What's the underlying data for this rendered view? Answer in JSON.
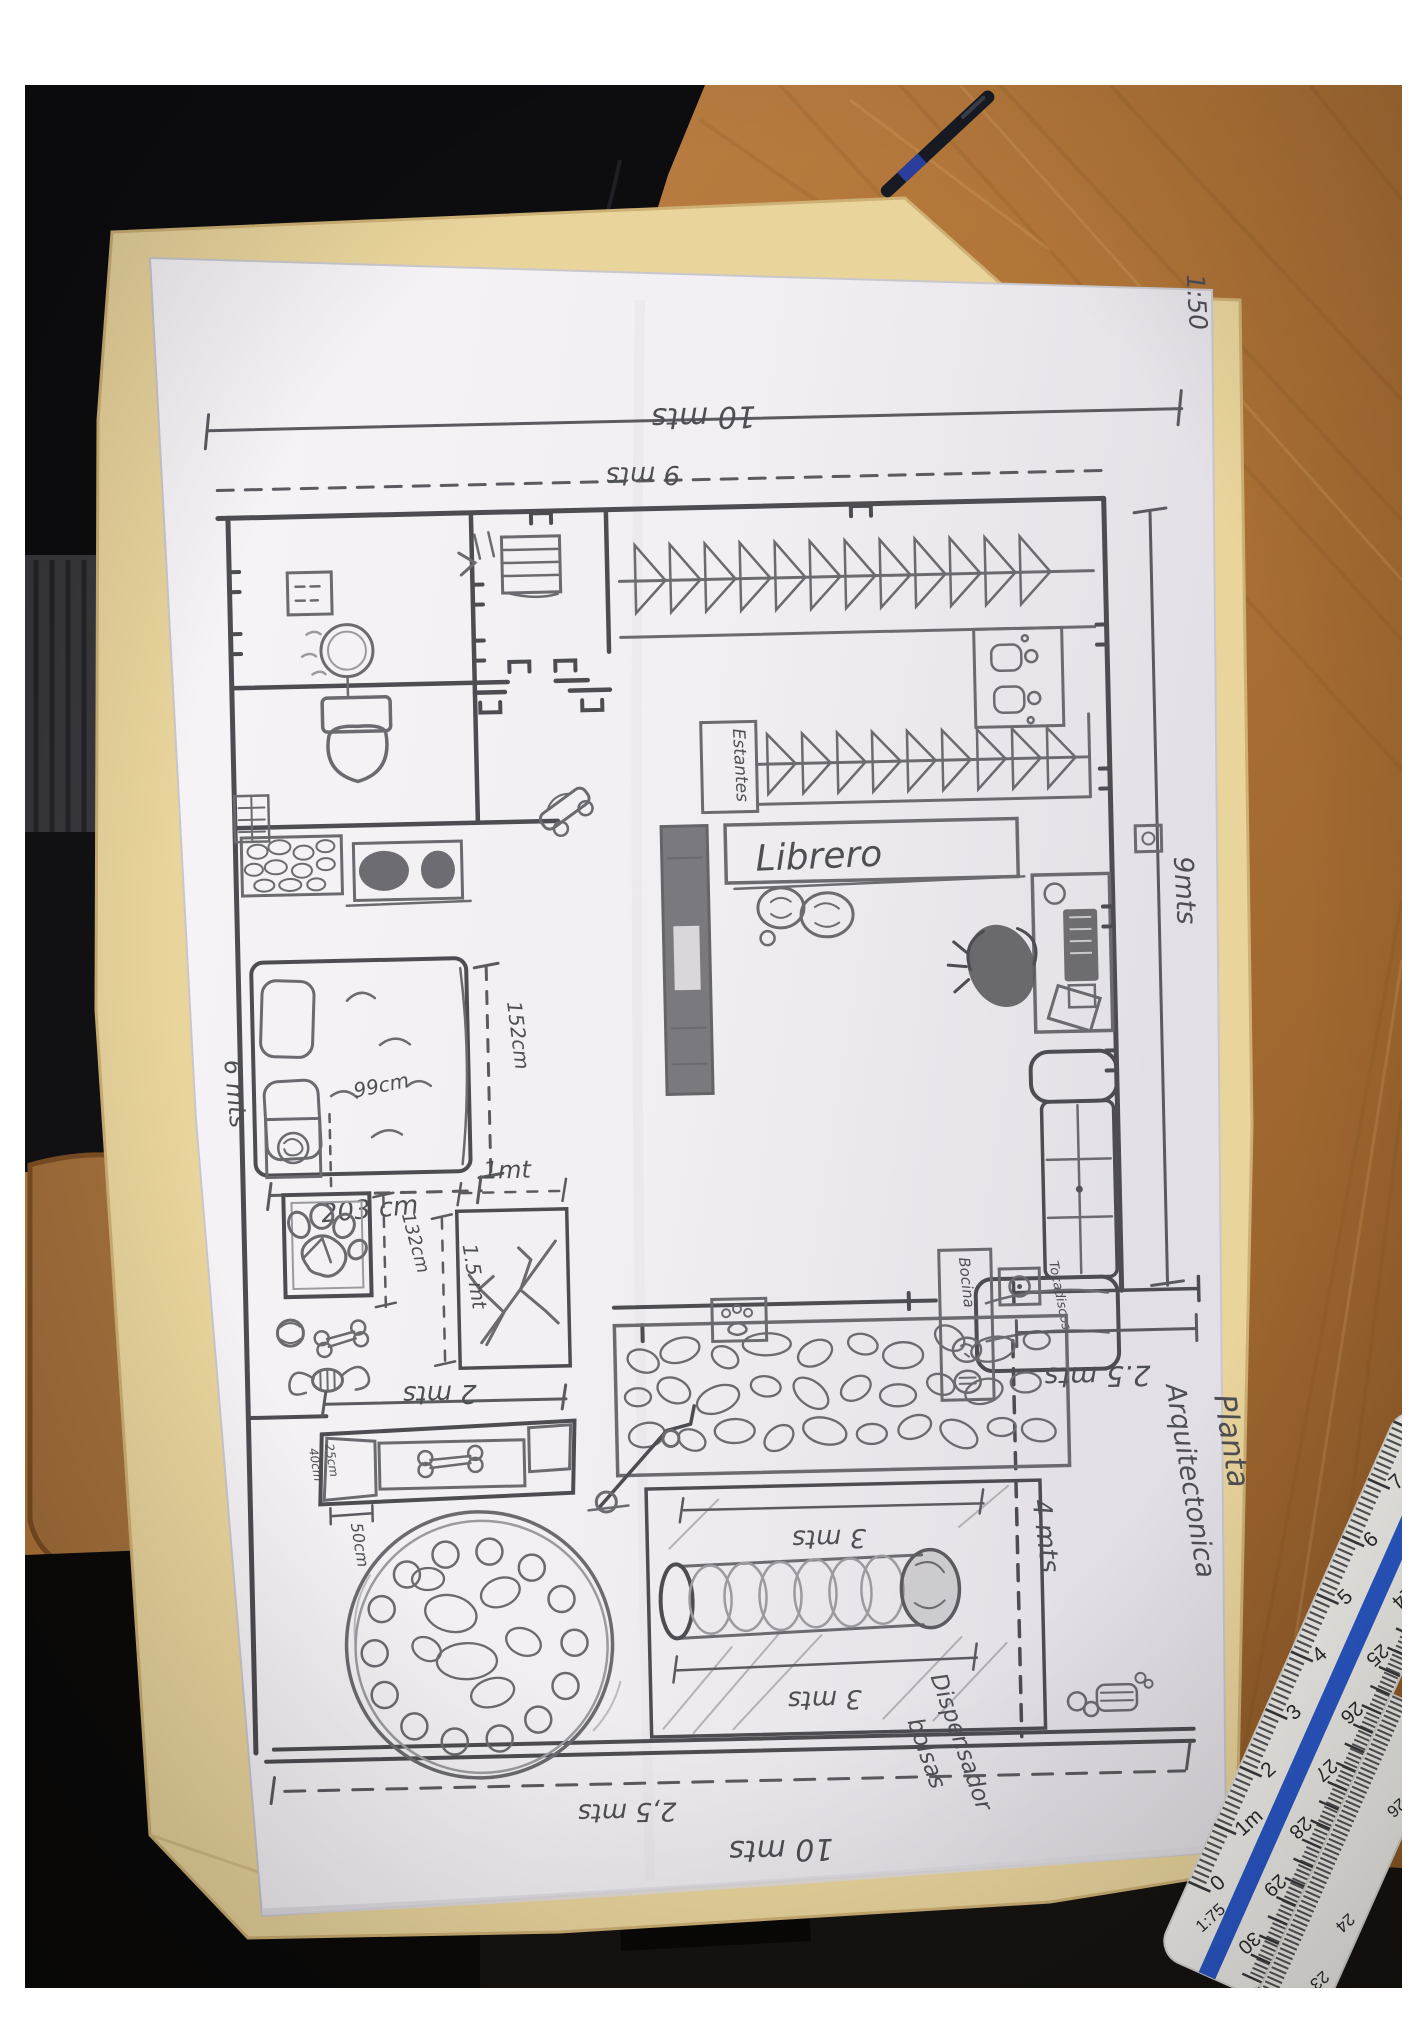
{
  "plan": {
    "scale_note": "1:50",
    "title": {
      "line1": "Planta",
      "line2": "Arquitectonica"
    },
    "rooms": {
      "librero_label": "Librero",
      "estantes_label": "Estantes",
      "bocina_label": "Bocina",
      "tocadiscos_label": "Tocadiscos",
      "dispensador_label_line1": "Dispensador",
      "dispensador_label_line2": "bolsas"
    },
    "dimensions": {
      "top_outer": "10 mts",
      "top_inner": "9 mts",
      "right_side": "9mts",
      "left_side": "6 mts",
      "bed_width": "203 cm",
      "bed_depth": "152cm",
      "laundry_width": "99cm",
      "pet_bed_height": "132cm",
      "scratch_box_width": "1mt",
      "scratch_box_height": "1.5 mt",
      "feeder_width": "2 mts",
      "feeder_tiny_a": "25cm",
      "feeder_tiny_b": "40cm",
      "bowl_size": "50cm",
      "tunnel_top": "3 mts",
      "tunnel_bottom": "3 mts",
      "right_section": "2.5 mts",
      "right_lower": "4 mts",
      "bottom_inner": "2,5 mts",
      "bottom_outer": "10 mts"
    }
  },
  "ruler": {
    "scale_label": "1:75",
    "top_scale": [
      "0",
      "1m",
      "2",
      "3",
      "4",
      "5",
      "6",
      "7"
    ],
    "bottom_scale": [
      "30",
      "29",
      "28",
      "27",
      "26",
      "25",
      "24",
      "23"
    ],
    "corner_scale": [
      "23",
      "24",
      "25",
      "26"
    ]
  },
  "colors": {
    "wood": "#b07437",
    "folder": "#e9d49c",
    "paper": "#f3f1f4",
    "pencil": "#55555a",
    "ruler_stripe": "#2050c8",
    "pen_body": "#171a22"
  }
}
